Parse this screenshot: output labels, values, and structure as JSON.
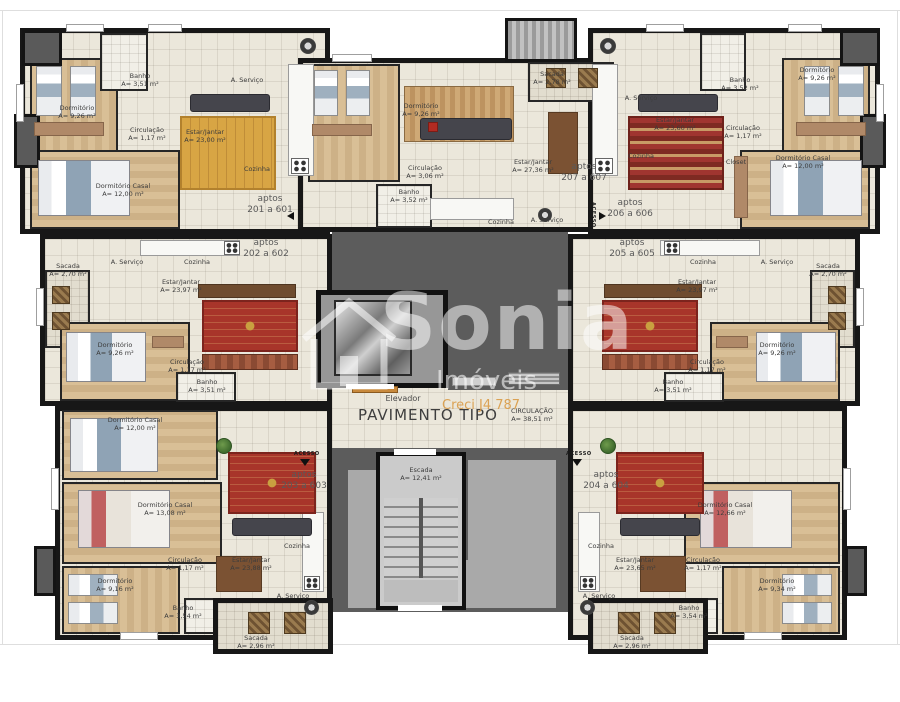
{
  "page": {
    "title_label": "PAVIMENTO TIPO"
  },
  "watermark": {
    "brand": "Sonia",
    "sub": "Imóveis",
    "creci": "Creci J4 787"
  },
  "core": {
    "elevator": "Elevador",
    "stairs_name": "Escada",
    "stairs_area": "A= 12,41 m²",
    "circulation_name": "CIRCULAÇÃO",
    "circulation_area": "A= 38,51 m²",
    "access": "ACESSO"
  },
  "apartments": [
    {
      "id": "201",
      "l1": "aptos",
      "l2": "201 a 601",
      "rooms": {
        "dorm": {
          "n": "Dormitório",
          "a": "A= 9,26 m²"
        },
        "banho": {
          "n": "Banho",
          "a": "A= 3,51 m²"
        },
        "aserv": {
          "n": "A. Serviço"
        },
        "circ": {
          "n": "Circulação",
          "a": "A= 1,17 m²"
        },
        "estar": {
          "n": "Estar/Jantar",
          "a": "A= 23,00 m²"
        },
        "coz": {
          "n": "Cozinha"
        },
        "dcasal": {
          "n": "Dormitório Casal",
          "a": "A= 12,00 m²"
        }
      }
    },
    {
      "id": "202",
      "l1": "aptos",
      "l2": "202 a 602",
      "rooms": {
        "sacada": {
          "n": "Sacada",
          "a": "A= 2,70 m²"
        },
        "aserv": {
          "n": "A. Serviço"
        },
        "coz": {
          "n": "Cozinha"
        },
        "estar": {
          "n": "Estar/Jantar",
          "a": "A= 23,97 m²"
        },
        "dorm": {
          "n": "Dormitório",
          "a": "A= 9,26 m²"
        },
        "circ": {
          "n": "Circulação",
          "a": "A= 1,17 m²"
        },
        "banho": {
          "n": "Banho",
          "a": "A= 3,51 m²"
        }
      }
    },
    {
      "id": "203",
      "l1": "aptos",
      "l2": "203 a 603",
      "rooms": {
        "dcasal1": {
          "n": "Dormitório Casal",
          "a": "A= 12,00 m²"
        },
        "dcasal2": {
          "n": "Dormitório Casal",
          "a": "A= 13,08 m²"
        },
        "dorm": {
          "n": "Dormitório",
          "a": "A= 9,16 m²"
        },
        "circ": {
          "n": "Circulação",
          "a": "A= 1,17 m²"
        },
        "banho": {
          "n": "Banho",
          "a": "A= 3,54 m²"
        },
        "estar": {
          "n": "Estar/Jantar",
          "a": "A= 23,88 m²"
        },
        "coz": {
          "n": "Cozinha"
        },
        "aserv": {
          "n": "A. Serviço"
        },
        "sacada": {
          "n": "Sacada",
          "a": "A= 2,96 m²"
        }
      }
    },
    {
      "id": "204",
      "l1": "aptos",
      "l2": "204 a 604",
      "rooms": {
        "coz": {
          "n": "Cozinha"
        },
        "estar": {
          "n": "Estar/Jantar",
          "a": "A= 23,65 m²"
        },
        "dcasal": {
          "n": "Dormitório Casal",
          "a": "A= 12,66 m²"
        },
        "dorm": {
          "n": "Dormitório",
          "a": "A= 9,34 m²"
        },
        "circ": {
          "n": "Circulação",
          "a": "A= 1,17 m²"
        },
        "banho": {
          "n": "Banho",
          "a": "A= 3,54 m²"
        },
        "aserv": {
          "n": "A. Serviço"
        },
        "sacada": {
          "n": "Sacada",
          "a": "A= 2,96 m²"
        }
      }
    },
    {
      "id": "205",
      "l1": "aptos",
      "l2": "205 a 605",
      "rooms": {
        "coz": {
          "n": "Cozinha"
        },
        "aserv": {
          "n": "A. Serviço"
        },
        "sacada": {
          "n": "Sacada",
          "a": "A= 2,70 m²"
        },
        "estar": {
          "n": "Estar/Jantar",
          "a": "A= 23,97 m²"
        },
        "dorm": {
          "n": "Dormitório",
          "a": "A= 9,26 m²"
        },
        "circ": {
          "n": "Circulação",
          "a": "A= 1,17 m²"
        },
        "banho": {
          "n": "Banho",
          "a": "A= 3,51 m²"
        }
      }
    },
    {
      "id": "206",
      "l1": "aptos",
      "l2": "206 a 606",
      "rooms": {
        "aserv": {
          "n": "A. Serviço"
        },
        "coz": {
          "n": "Cozinha"
        },
        "estar": {
          "n": "Estar/Jantar",
          "a": "A= 23,60 m²"
        },
        "banho": {
          "n": "Banho",
          "a": "A= 3,52 m²"
        },
        "circ": {
          "n": "Circulação",
          "a": "A= 1,17 m²"
        },
        "dorm": {
          "n": "Dormitório",
          "a": "A= 9,26 m²"
        },
        "dcasal": {
          "n": "Dormitório Casal",
          "a": "A= 12,00 m²"
        },
        "closet": {
          "n": "Closet"
        }
      }
    },
    {
      "id": "207",
      "l1": "aptos",
      "l2": "207 a 607",
      "rooms": {
        "dorm": {
          "n": "Dormitório",
          "a": "A= 9,26 m²"
        },
        "sacada": {
          "n": "Sacada",
          "a": "A= 2,78 m²"
        },
        "estar": {
          "n": "Estar/Jantar",
          "a": "A= 27,36 m²"
        },
        "circ": {
          "n": "Circulação",
          "a": "A= 3,06 m²"
        },
        "banho": {
          "n": "Banho",
          "a": "A= 3,52 m²"
        },
        "coz": {
          "n": "Cozinha"
        },
        "aserv": {
          "n": "A. Serviço"
        }
      }
    }
  ]
}
